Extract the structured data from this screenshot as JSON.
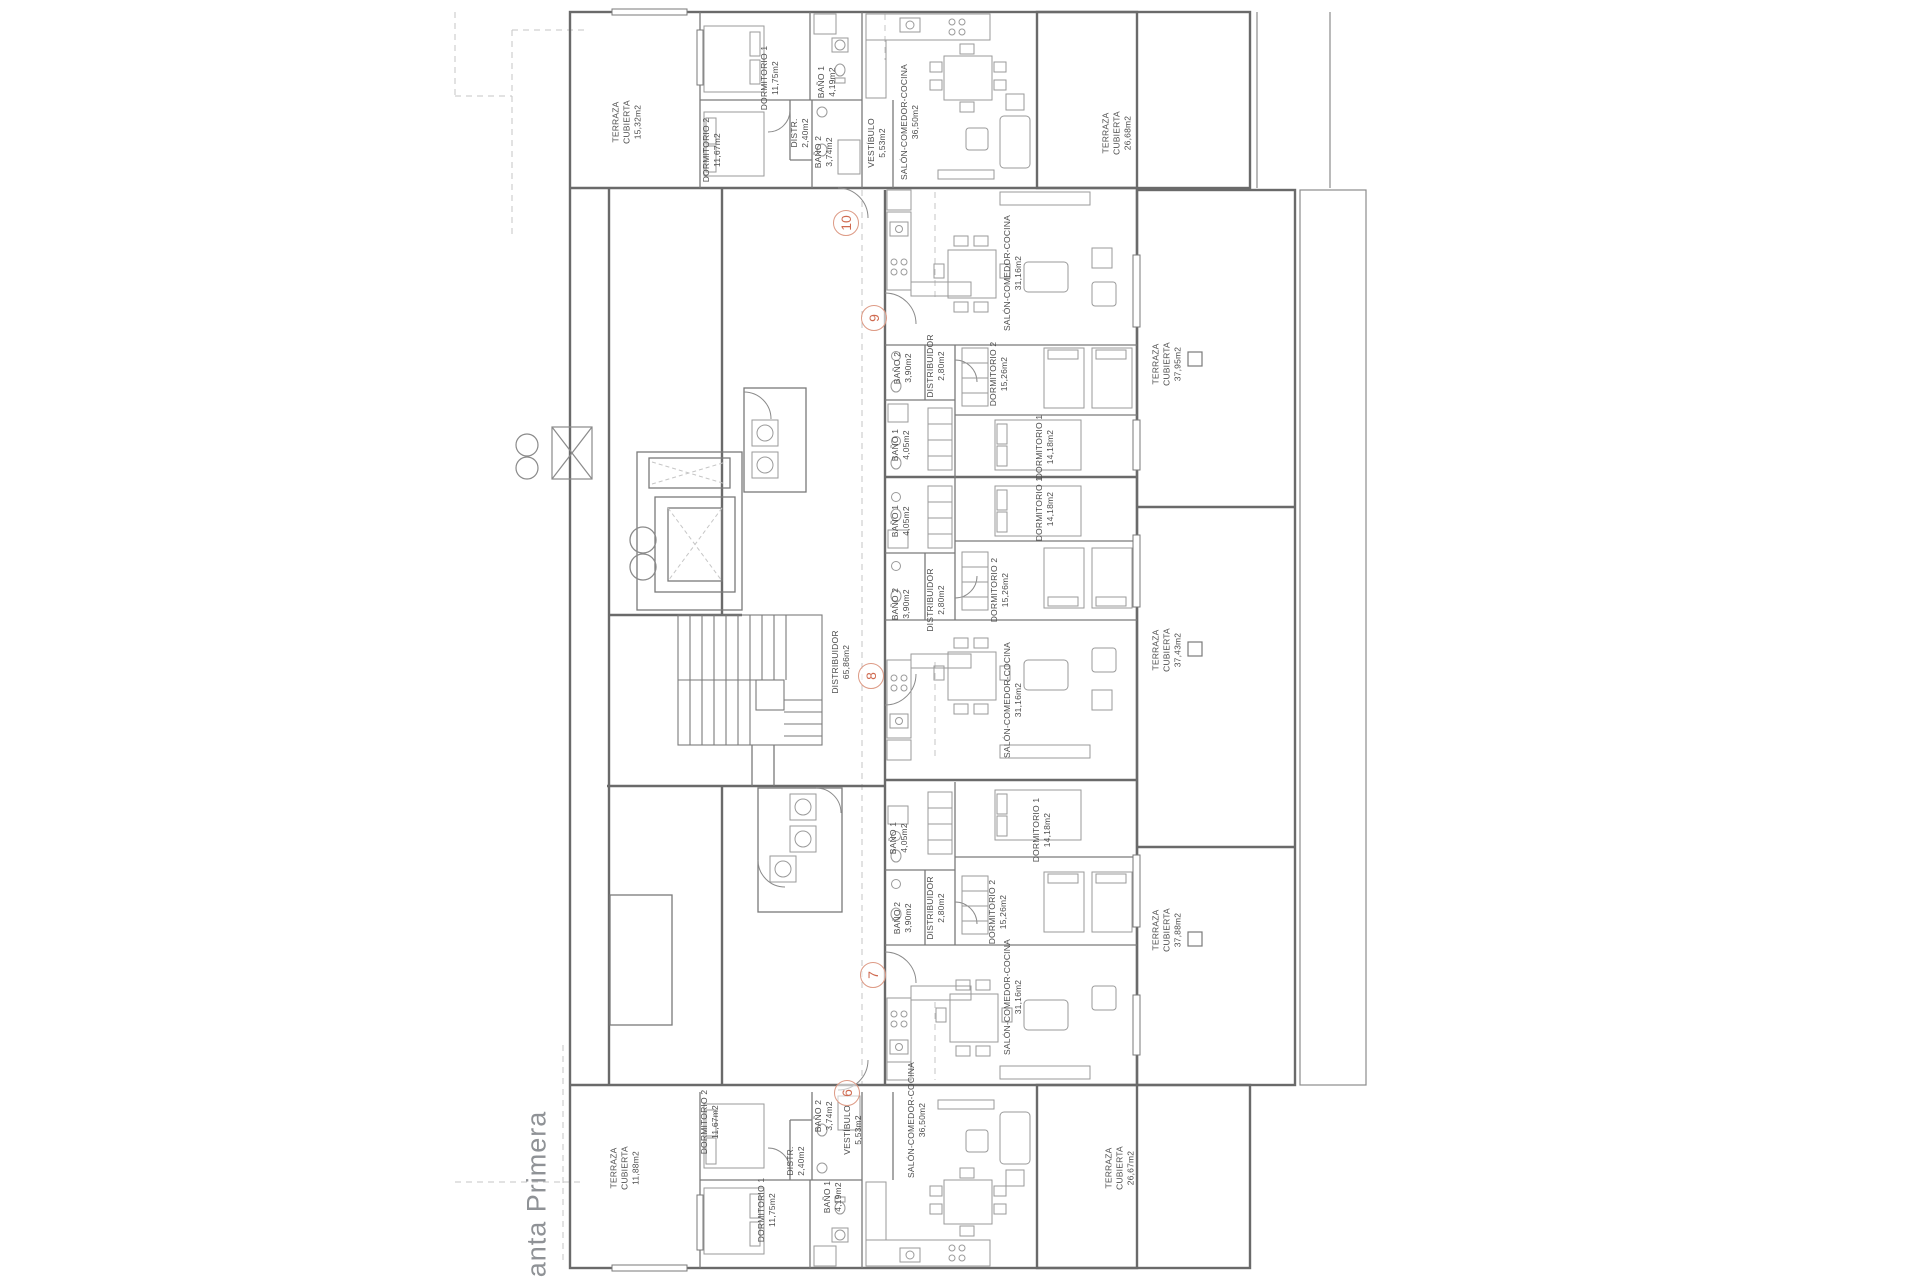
{
  "title": "Planta Primera",
  "colors": {
    "wall": "#6a6a6a",
    "partition": "#7a7a7a",
    "furniture": "#9a9a9a",
    "dashed": "#c6c6c6",
    "label": "#4d4d4d",
    "unit_ring": "#dd9a85",
    "unit_text": "#cf6a50"
  },
  "plan": {
    "rooms": [
      {
        "id": "terraza-10-left",
        "lines": [
          "TERRAZA",
          "CUBIERTA",
          "15,32m2"
        ],
        "x": 627,
        "y": 122
      },
      {
        "id": "dormitorio1-10",
        "lines": [
          "DORMITORIO 1",
          "11,75m2"
        ],
        "x": 770,
        "y": 78
      },
      {
        "id": "bano1-10",
        "lines": [
          "BAÑO 1",
          "4,19m2"
        ],
        "x": 827,
        "y": 82
      },
      {
        "id": "distr-10",
        "lines": [
          "DISTR.",
          "2,40m2"
        ],
        "x": 800,
        "y": 133
      },
      {
        "id": "dormitorio2-10",
        "lines": [
          "DORMITORIO 2",
          "11,67m2"
        ],
        "x": 712,
        "y": 150
      },
      {
        "id": "bano2-10",
        "lines": [
          "BAÑO 2",
          "3,74m2"
        ],
        "x": 824,
        "y": 152
      },
      {
        "id": "vestibulo-10",
        "lines": [
          "VESTÍBULO",
          "5,53m2"
        ],
        "x": 877,
        "y": 143
      },
      {
        "id": "salon-10",
        "lines": [
          "SALÓN-COMEDOR-COCINA",
          "36,50m2"
        ],
        "x": 910,
        "y": 122
      },
      {
        "id": "terraza-10-right",
        "lines": [
          "TERRAZA",
          "CUBIERTA",
          "26,68m2"
        ],
        "x": 1117,
        "y": 133
      },
      {
        "id": "salon-9",
        "lines": [
          "SALÓN-COMEDOR-COCINA",
          "31,16m2"
        ],
        "x": 1013,
        "y": 273
      },
      {
        "id": "bano2-9",
        "lines": [
          "BAÑO 2",
          "3,90m2"
        ],
        "x": 903,
        "y": 368
      },
      {
        "id": "distribuidor-9",
        "lines": [
          "DISTRIBUIDOR",
          "2,80m2"
        ],
        "x": 936,
        "y": 366
      },
      {
        "id": "dormitorio2-9",
        "lines": [
          "DORMITORIO 2",
          "15,26m2"
        ],
        "x": 999,
        "y": 374
      },
      {
        "id": "bano1-9",
        "lines": [
          "BAÑO 1",
          "4,05m2"
        ],
        "x": 901,
        "y": 445
      },
      {
        "id": "dormitorio1-9",
        "lines": [
          "DORMITORIO 1",
          "14,18m2"
        ],
        "x": 1045,
        "y": 447
      },
      {
        "id": "terraza-band-1",
        "lines": [
          "TERRAZA",
          "CUBIERTA",
          "37,95m2"
        ],
        "x": 1167,
        "y": 364
      },
      {
        "id": "dormitorio1-8",
        "lines": [
          "DORMITORIO 1",
          "14,18m2"
        ],
        "x": 1045,
        "y": 509
      },
      {
        "id": "bano1-8",
        "lines": [
          "BAÑO 1",
          "4,05m2"
        ],
        "x": 901,
        "y": 521
      },
      {
        "id": "bano2-8",
        "lines": [
          "BAÑO 2",
          "3,90m2"
        ],
        "x": 901,
        "y": 604
      },
      {
        "id": "distribuidor-8",
        "lines": [
          "DISTRIBUIDOR",
          "2,80m2"
        ],
        "x": 936,
        "y": 600
      },
      {
        "id": "dormitorio2-8",
        "lines": [
          "DORMITORIO 2",
          "15,26m2"
        ],
        "x": 1000,
        "y": 590
      },
      {
        "id": "salon-8",
        "lines": [
          "SALÓN-COMEDOR-COCINA",
          "31,16m2"
        ],
        "x": 1013,
        "y": 700
      },
      {
        "id": "terraza-band-2",
        "lines": [
          "TERRAZA",
          "CUBIERTA",
          "37,43m2"
        ],
        "x": 1167,
        "y": 650
      },
      {
        "id": "distribuidor-comun",
        "lines": [
          "DISTRIBUIDOR",
          "65,86m2"
        ],
        "x": 841,
        "y": 662
      },
      {
        "id": "dormitorio1-7",
        "lines": [
          "DORMITORIO 1",
          "14,18m2"
        ],
        "x": 1042,
        "y": 830
      },
      {
        "id": "bano1-7",
        "lines": [
          "BAÑO 1",
          "4,05m2"
        ],
        "x": 899,
        "y": 838
      },
      {
        "id": "bano2-7",
        "lines": [
          "BAÑO 2",
          "3,90m2"
        ],
        "x": 903,
        "y": 918
      },
      {
        "id": "distribuidor-7",
        "lines": [
          "DISTRIBUIDOR",
          "2,80m2"
        ],
        "x": 936,
        "y": 908
      },
      {
        "id": "dormitorio2-7",
        "lines": [
          "DORMITORIO 2",
          "15,26m2"
        ],
        "x": 998,
        "y": 912
      },
      {
        "id": "salon-7",
        "lines": [
          "SALÓN-COMEDOR-COCINA",
          "31,16m2"
        ],
        "x": 1013,
        "y": 997
      },
      {
        "id": "terraza-band-3",
        "lines": [
          "TERRAZA",
          "CUBIERTA",
          "37,88m2"
        ],
        "x": 1167,
        "y": 930
      },
      {
        "id": "vestibulo-6",
        "lines": [
          "VESTÍBULO",
          "5,53m2"
        ],
        "x": 853,
        "y": 1130
      },
      {
        "id": "salon-6",
        "lines": [
          "SALÓN-COMEDOR-COCINA",
          "36,50m2"
        ],
        "x": 917,
        "y": 1120
      },
      {
        "id": "dormitorio2-6",
        "lines": [
          "DORMITORIO 2",
          "11,67m2"
        ],
        "x": 710,
        "y": 1122
      },
      {
        "id": "bano2-6",
        "lines": [
          "BAÑO 2",
          "3,74m2"
        ],
        "x": 824,
        "y": 1116
      },
      {
        "id": "distr-6",
        "lines": [
          "DISTR.",
          "2,40m2"
        ],
        "x": 796,
        "y": 1161
      },
      {
        "id": "dormitorio1-6",
        "lines": [
          "DORMITORIO 1",
          "11,75m2"
        ],
        "x": 767,
        "y": 1210
      },
      {
        "id": "bano1-6",
        "lines": [
          "BAÑO 1",
          "4,19m2"
        ],
        "x": 833,
        "y": 1197
      },
      {
        "id": "terraza-6-left",
        "lines": [
          "TERRAZA",
          "CUBIERTA",
          "11,88m2"
        ],
        "x": 625,
        "y": 1168
      },
      {
        "id": "terraza-6-right",
        "lines": [
          "TERRAZA",
          "CUBIERTA",
          "26,67m2"
        ],
        "x": 1120,
        "y": 1168
      }
    ],
    "units": [
      {
        "number": "10",
        "x": 846,
        "y": 223
      },
      {
        "number": "9",
        "x": 874,
        "y": 318
      },
      {
        "number": "8",
        "x": 871,
        "y": 676
      },
      {
        "number": "7",
        "x": 873,
        "y": 975
      },
      {
        "number": "6",
        "x": 847,
        "y": 1093
      }
    ]
  }
}
